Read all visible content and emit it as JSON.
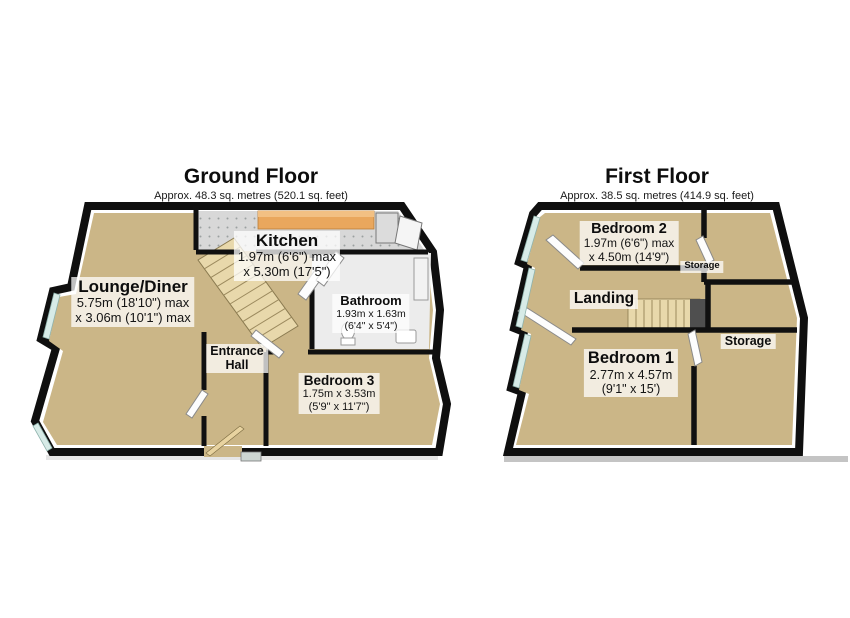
{
  "page": {
    "width": 850,
    "height": 618
  },
  "colors": {
    "wall": "#0f0f0f",
    "floor_tan": "#cbb687",
    "kitchen_floor": "#d8d8d8",
    "bathroom_floor": "#ececec",
    "counter_orange": "#e9a75d",
    "stairs": "#e8d8ab",
    "window_glass": "#d7ebe7",
    "stairwell_dark": "#4f4f4f",
    "label_background": "rgba(255,255,255,0.74)"
  },
  "ground_floor": {
    "title": "Ground Floor",
    "subtitle": "Approx. 48.3 sq. metres (520.1 sq. feet)",
    "rooms": {
      "lounge_diner": {
        "name": "Lounge/Diner",
        "dim1": "5.75m (18'10\") max",
        "dim2": "x 3.06m (10'1\") max"
      },
      "kitchen": {
        "name": "Kitchen",
        "dim1": "1.97m (6'6\") max",
        "dim2": "x 5.30m (17'5\")"
      },
      "bathroom": {
        "name": "Bathroom",
        "dim1": "1.93m x 1.63m",
        "dim2": "(6'4\" x 5'4\")"
      },
      "entrance_hall": {
        "name_line1": "Entrance",
        "name_line2": "Hall"
      },
      "bedroom3": {
        "name": "Bedroom 3",
        "dim1": "1.75m x 3.53m",
        "dim2": "(5'9\" x 11'7\")"
      }
    }
  },
  "first_floor": {
    "title": "First Floor",
    "subtitle": "Approx. 38.5 sq. metres (414.9 sq. feet)",
    "rooms": {
      "bedroom2": {
        "name": "Bedroom 2",
        "dim1": "1.97m (6'6\") max",
        "dim2": "x 4.50m (14'9\")"
      },
      "storage_top": {
        "name": "Storage"
      },
      "landing": {
        "name": "Landing"
      },
      "bedroom1": {
        "name": "Bedroom 1",
        "dim1": "2.77m x 4.57m",
        "dim2": "(9'1\" x 15')"
      },
      "storage_right": {
        "name": "Storage"
      }
    }
  }
}
